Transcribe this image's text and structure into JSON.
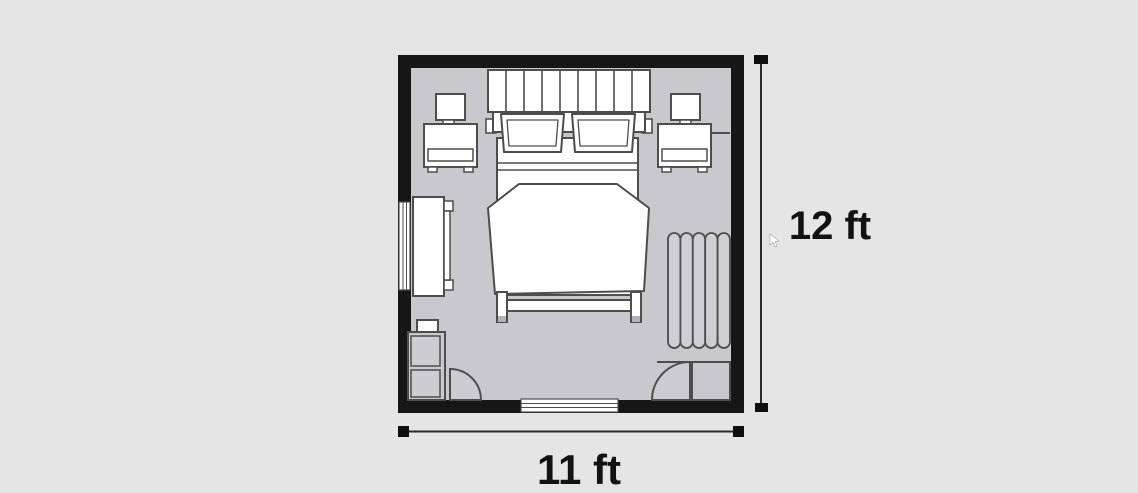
{
  "diagram": {
    "type": "floor-plan",
    "dimensions": {
      "height_label": "12 ft",
      "width_label": "11 ft"
    },
    "furniture": [
      "headboard",
      "pillow-left",
      "pillow-right",
      "bed-mattress",
      "duvet",
      "footboard",
      "lamp-left",
      "nightstand-left",
      "lamp-right",
      "nightstand-right",
      "dresser",
      "radiator",
      "shelf-unit",
      "shelf-top-box",
      "door-bottom-left",
      "door-bottom-right",
      "closet",
      "window-left",
      "window-bottom"
    ]
  },
  "colors": {
    "background": "#e5e5e6",
    "wall": "#161616",
    "floor": "#c9c9cd",
    "furniture_fill": "#ffffff",
    "outline": "#4d4d4d",
    "dimension_text": "#121212"
  }
}
